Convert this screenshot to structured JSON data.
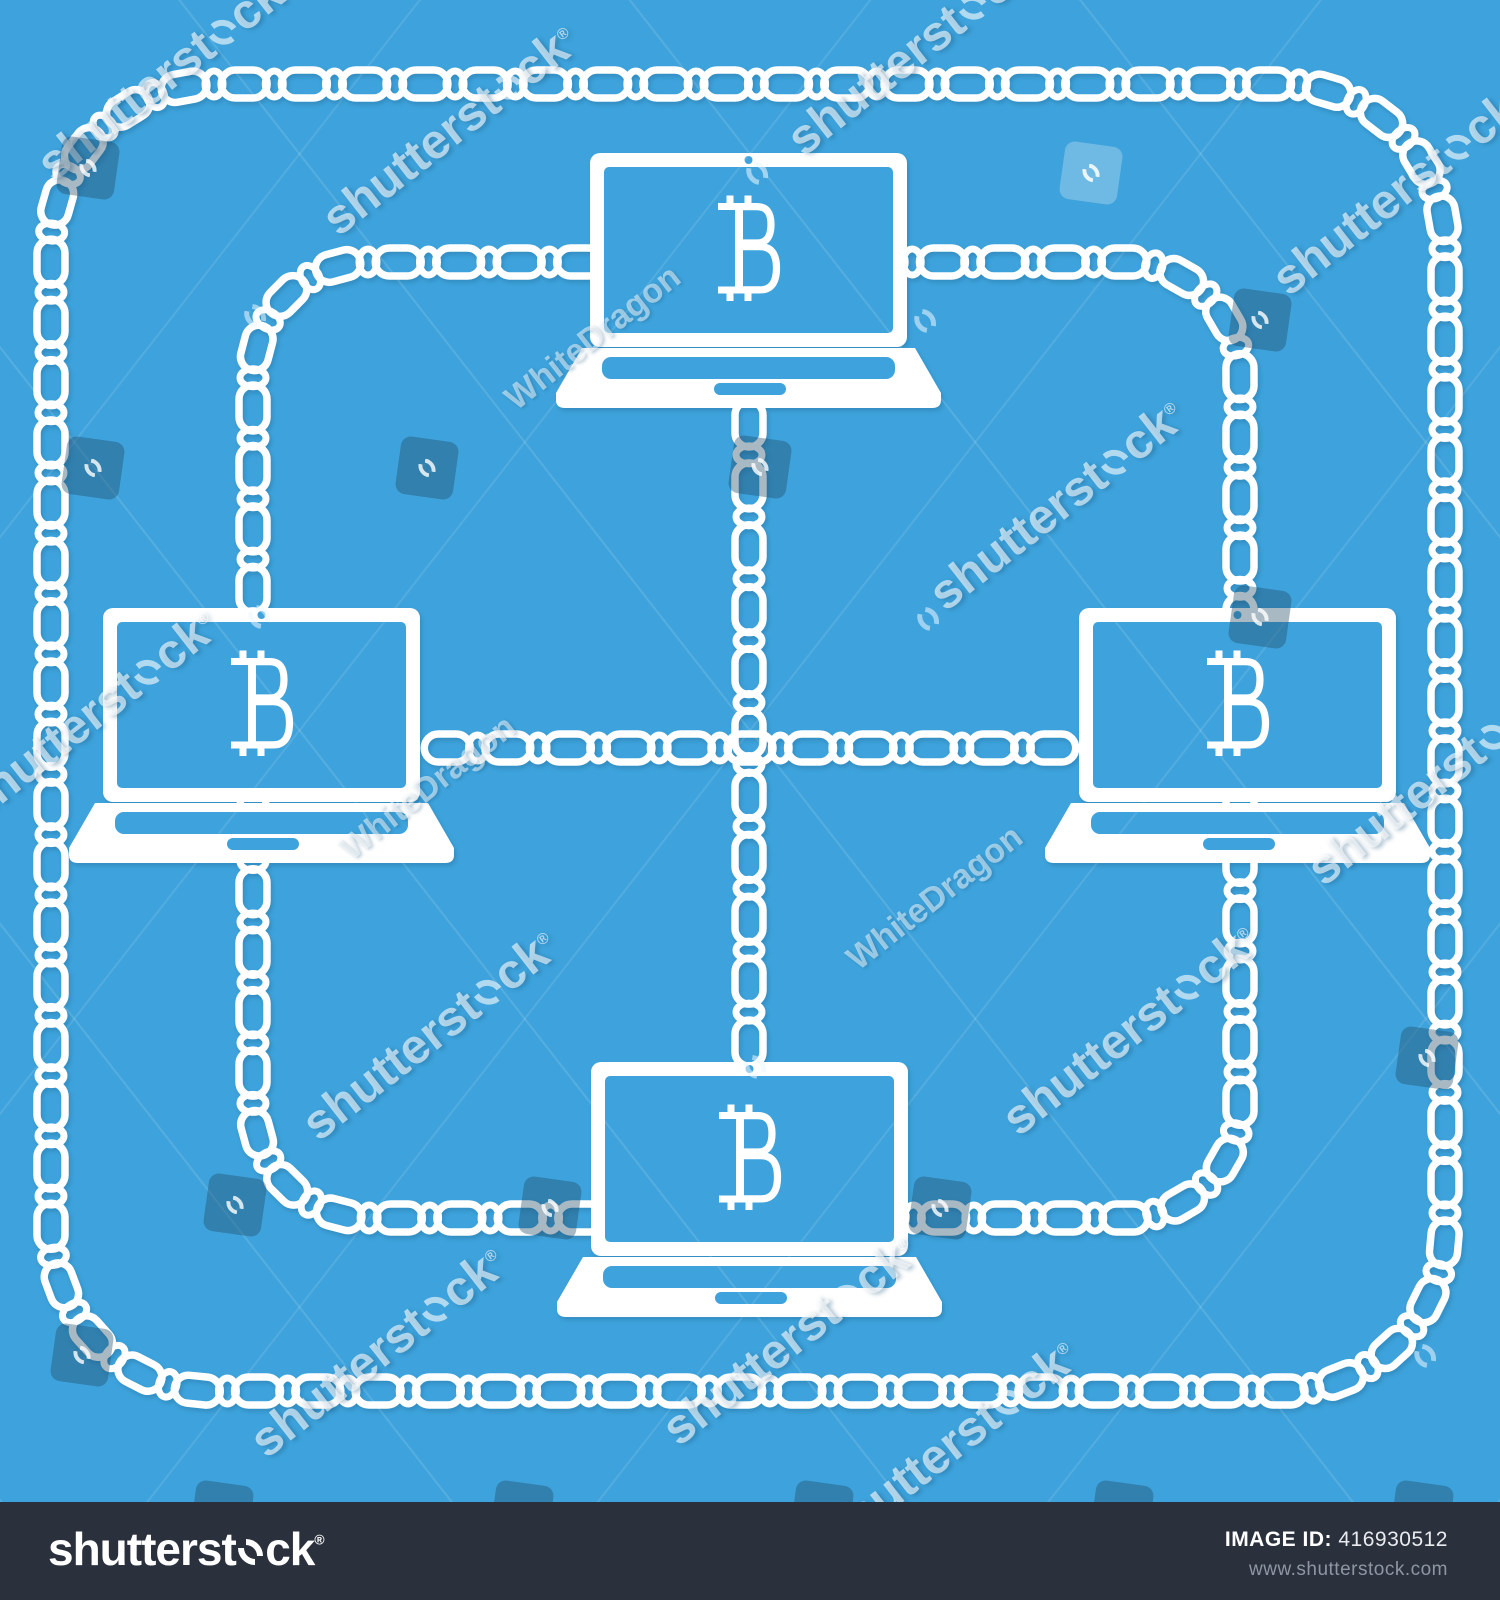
{
  "canvas": {
    "width": 1500,
    "height": 1600,
    "bg_color": "#3EA3DC",
    "art_color": "#FFFFFF"
  },
  "illustration": {
    "laptops": [
      {
        "id": "laptop-top",
        "x": 556,
        "y": 153,
        "screen_symbol": "bitcoin-sign"
      },
      {
        "id": "laptop-left",
        "x": 69,
        "y": 608,
        "screen_symbol": "bitcoin-sign"
      },
      {
        "id": "laptop-right",
        "x": 1045,
        "y": 608,
        "screen_symbol": "bitcoin-sign"
      },
      {
        "id": "laptop-bottom",
        "x": 557,
        "y": 1062,
        "screen_symbol": "bitcoin-sign"
      }
    ],
    "chains": [
      {
        "id": "chain-outer-ring",
        "type": "ring",
        "x1": 51,
        "y1": 84,
        "x2": 1445,
        "y2": 1391,
        "r": 163
      },
      {
        "id": "chain-inner-ring",
        "type": "ring",
        "x1": 253,
        "y1": 262,
        "x2": 1240,
        "y2": 1218,
        "r": 115
      },
      {
        "id": "chain-center-vertical",
        "type": "line",
        "x1": 749,
        "y1": 393,
        "x2": 749,
        "y2": 1074
      },
      {
        "id": "chain-center-horizontal",
        "type": "line",
        "x1": 417,
        "y1": 748,
        "x2": 1083,
        "y2": 748
      }
    ],
    "link_style": {
      "length": 46,
      "height": 28,
      "stroke": 7.5,
      "unit": 60,
      "ellipse_rx": 9,
      "ellipse_ry": 13,
      "ellipse_stroke": 7
    }
  },
  "watermarks": {
    "brand": {
      "prefix": "shutterst",
      "suffix": "ck",
      "reg": "®"
    },
    "author": "WhiteDragon",
    "text_positions": [
      {
        "x": 165,
        "y": 75
      },
      {
        "x": 450,
        "y": 130
      },
      {
        "x": 915,
        "y": 50
      },
      {
        "x": 1400,
        "y": 190
      },
      {
        "x": 90,
        "y": 715
      },
      {
        "x": 1057,
        "y": 505
      },
      {
        "x": 1435,
        "y": 780
      },
      {
        "x": 430,
        "y": 1035
      },
      {
        "x": 1130,
        "y": 1030
      },
      {
        "x": 378,
        "y": 1352
      },
      {
        "x": 790,
        "y": 1340
      },
      {
        "x": 950,
        "y": 1445
      }
    ],
    "author_positions": [
      {
        "x": 593,
        "y": 338
      },
      {
        "x": 428,
        "y": 788
      },
      {
        "x": 935,
        "y": 898
      }
    ],
    "icon_positions": [
      {
        "x": 255,
        "y": 315
      },
      {
        "x": 757,
        "y": 172
      },
      {
        "x": 925,
        "y": 320
      },
      {
        "x": 259,
        "y": 616
      },
      {
        "x": 928,
        "y": 618
      },
      {
        "x": 755,
        "y": 1066
      },
      {
        "x": 1425,
        "y": 1355
      }
    ],
    "badge_positions": [
      {
        "x": 88,
        "y": 168,
        "variant": "dark"
      },
      {
        "x": 1091,
        "y": 173,
        "variant": "light"
      },
      {
        "x": 1260,
        "y": 320,
        "variant": "dark"
      },
      {
        "x": 93,
        "y": 468,
        "variant": "dark"
      },
      {
        "x": 427,
        "y": 468,
        "variant": "dark"
      },
      {
        "x": 760,
        "y": 467,
        "variant": "dark"
      },
      {
        "x": 1260,
        "y": 617,
        "variant": "dark"
      },
      {
        "x": 1427,
        "y": 1058,
        "variant": "dark"
      },
      {
        "x": 235,
        "y": 1205,
        "variant": "dark"
      },
      {
        "x": 550,
        "y": 1208,
        "variant": "dark"
      },
      {
        "x": 940,
        "y": 1208,
        "variant": "dark"
      },
      {
        "x": 82,
        "y": 1355,
        "variant": "dark"
      },
      {
        "x": 222,
        "y": 1512,
        "variant": "dark"
      },
      {
        "x": 522,
        "y": 1512,
        "variant": "dark"
      },
      {
        "x": 822,
        "y": 1512,
        "variant": "dark"
      },
      {
        "x": 1122,
        "y": 1512,
        "variant": "dark"
      },
      {
        "x": 1422,
        "y": 1512,
        "variant": "dark"
      }
    ]
  },
  "footer": {
    "bg_color": "#2A313D",
    "image_id_label": "IMAGE ID:",
    "image_id_value": "416930512",
    "url": "www.shutterstock.com"
  }
}
